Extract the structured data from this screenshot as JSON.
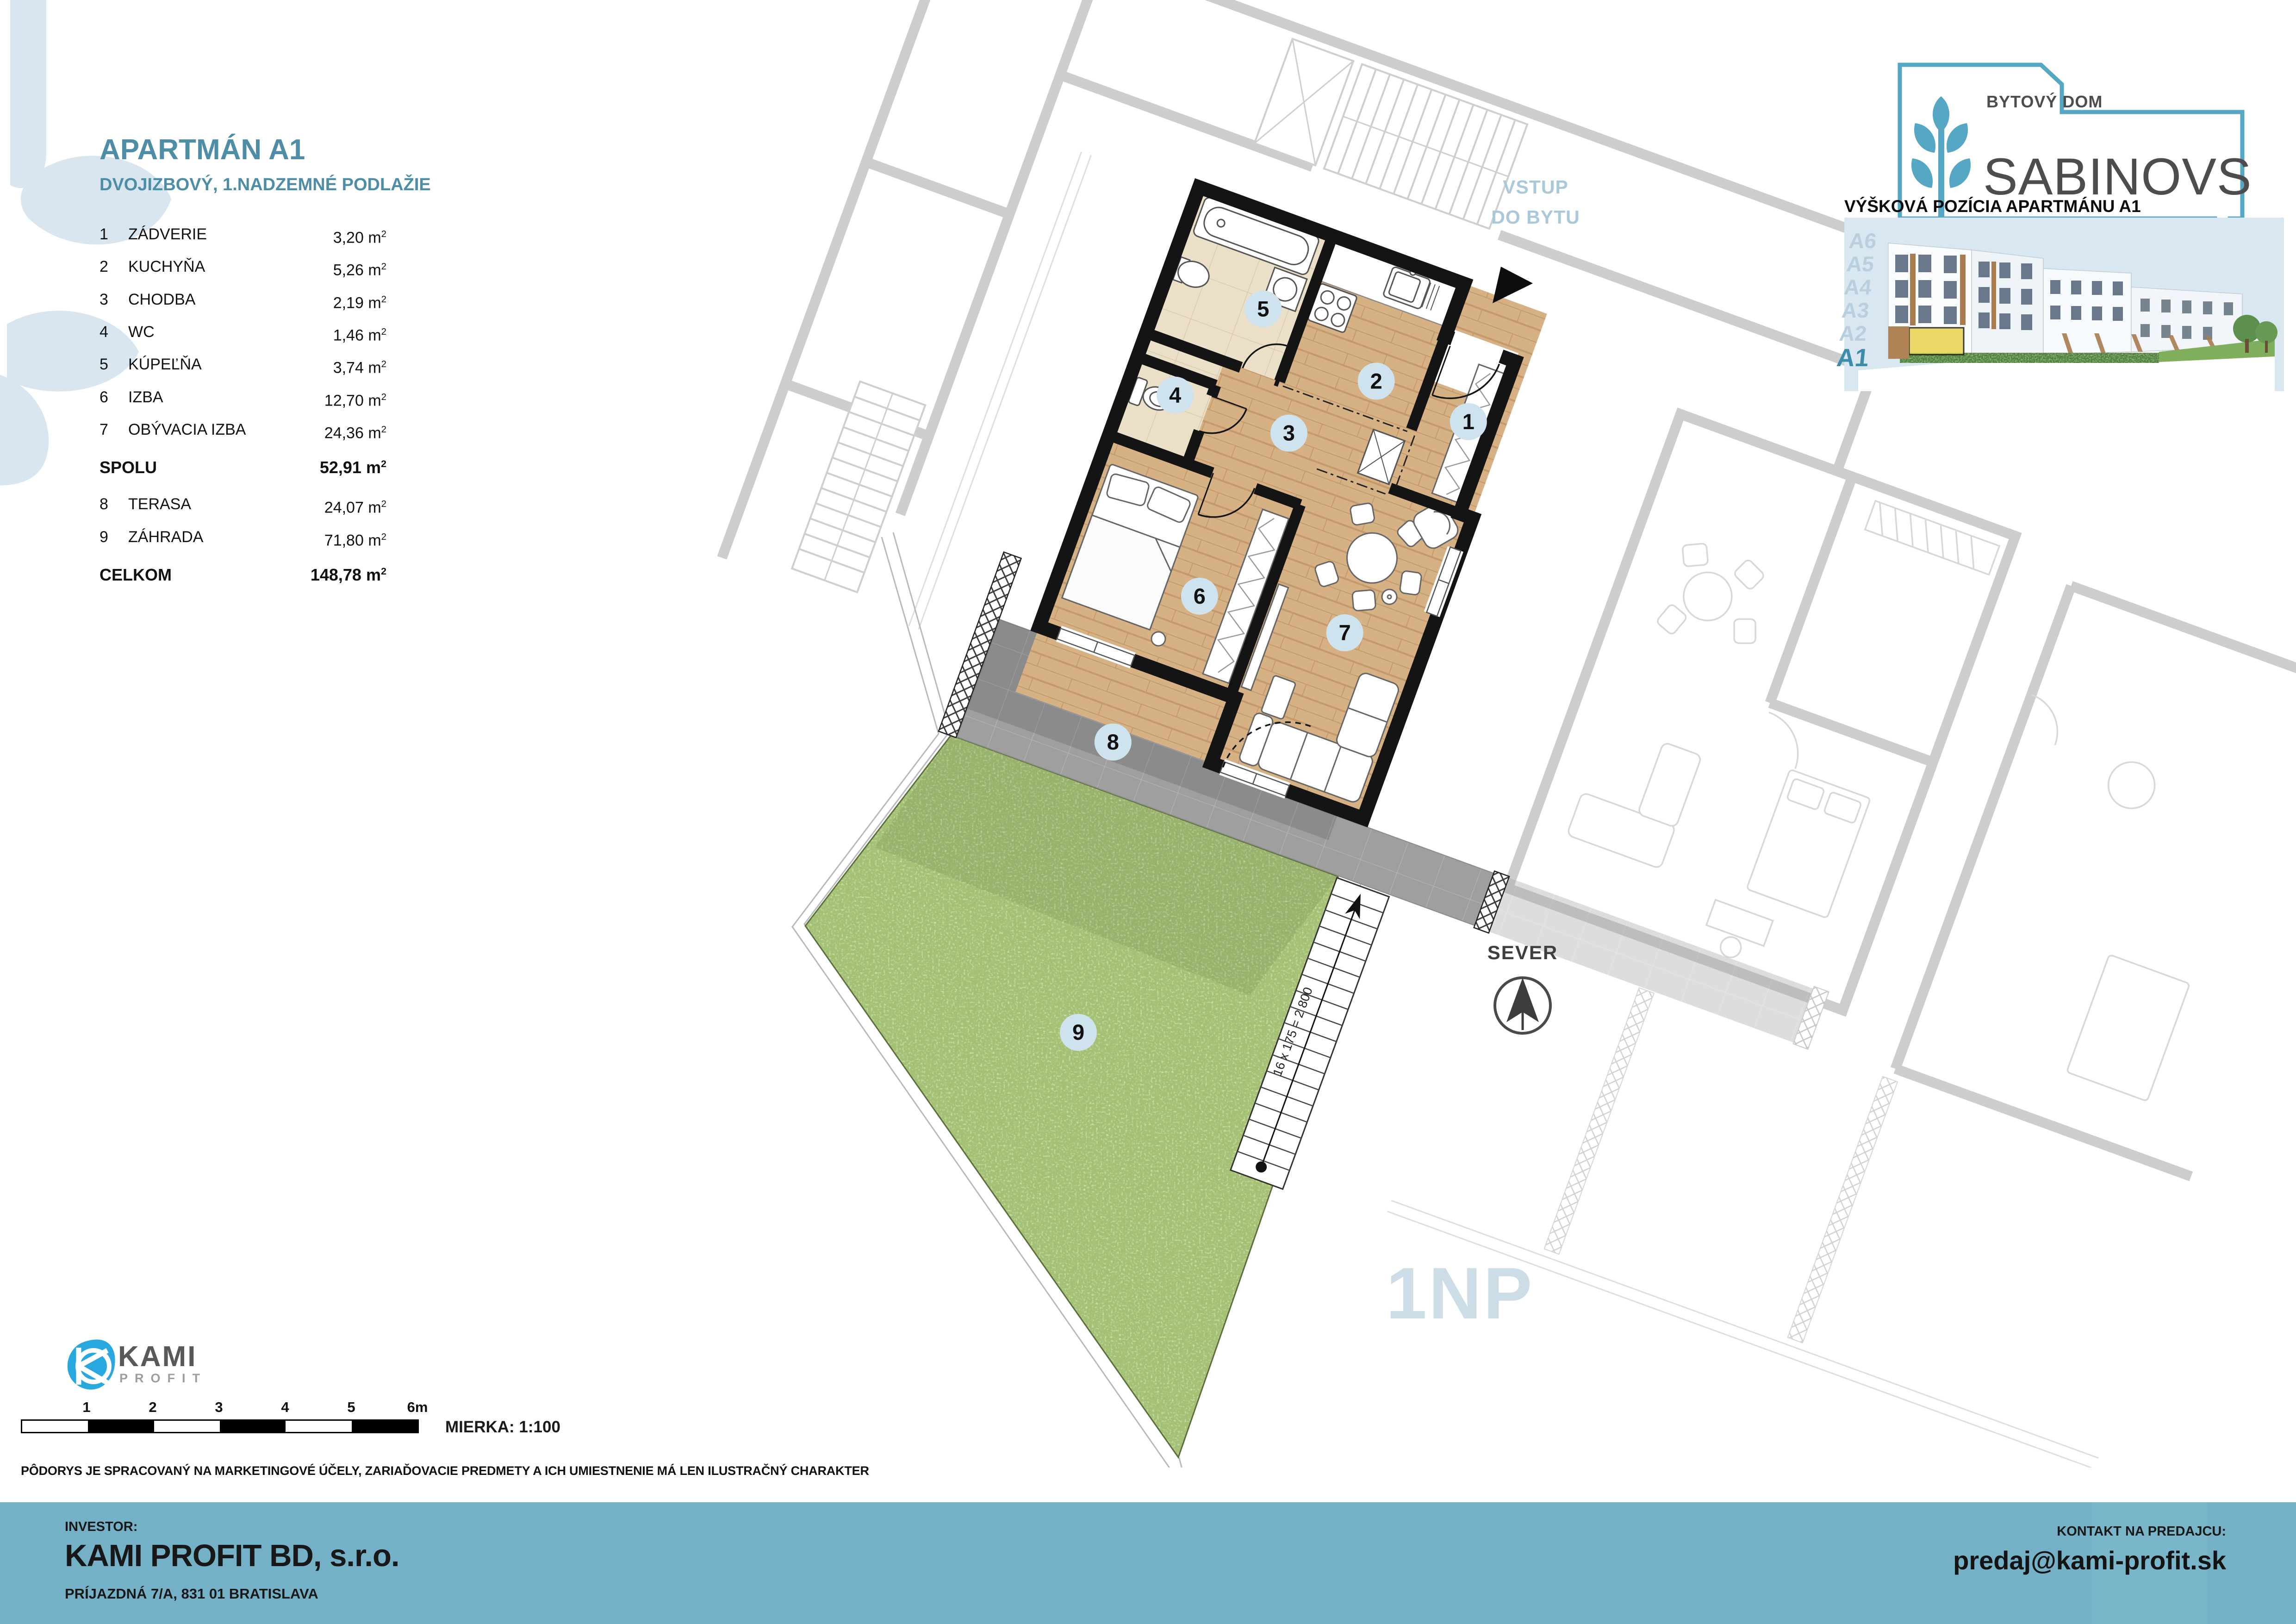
{
  "header": {
    "title": "APARTMÁN A1",
    "subtitle": "DVOJIZBOVÝ, 1.NADZEMNÉ PODLAŽIE"
  },
  "rooms": [
    {
      "no": "1",
      "name": "ZÁDVERIE",
      "value": "3,20"
    },
    {
      "no": "2",
      "name": "KUCHYŇA",
      "value": "5,26"
    },
    {
      "no": "3",
      "name": "CHODBA",
      "value": "2,19"
    },
    {
      "no": "4",
      "name": "WC",
      "value": "1,46"
    },
    {
      "no": "5",
      "name": "KÚPEĽŇA",
      "value": "3,74"
    },
    {
      "no": "6",
      "name": "IZBA",
      "value": "12,70"
    },
    {
      "no": "7",
      "name": "OBÝVACIA IZBA",
      "value": "24,36"
    }
  ],
  "outdoor": [
    {
      "no": "8",
      "name": "TERASA",
      "value": "24,07"
    },
    {
      "no": "9",
      "name": "ZÁHRADA",
      "value": "71,80"
    }
  ],
  "totals": {
    "spolu_label": "SPOLU",
    "spolu_value": "52,91",
    "celkom_label": "CELKOM",
    "celkom_value": "148,78"
  },
  "unit": {
    "base": "m",
    "sup": "2"
  },
  "plan": {
    "badges": [
      "1",
      "2",
      "3",
      "4",
      "5",
      "6",
      "7",
      "8",
      "9"
    ],
    "entry_line1": "VSTUP",
    "entry_line2": "DO BYTU",
    "north_label": "SEVER",
    "floor_label": "1NP",
    "stairs_label": "16 x 175 = 2 800"
  },
  "brand": {
    "top": "BYTOVÝ DOM",
    "name": "SABINOVSKÁ"
  },
  "elevation": {
    "title": "VÝŠKOVÁ POZÍCIA APARTMÁNU A1",
    "levels": [
      "A6",
      "A5",
      "A4",
      "A3",
      "A2",
      "A1"
    ]
  },
  "scalebar": {
    "ticks": [
      "1",
      "2",
      "3",
      "4",
      "5",
      "6m"
    ],
    "scale_label": "MIERKA: 1:100"
  },
  "disclaimer": "PÔDORYS JE SPRACOVANÝ NA MARKETINGOVÉ ÚČELY, ZARIAĎOVACIE PREDMETY A ICH UMIESTNENIE MÁ LEN ILUSTRAČNÝ CHARAKTER",
  "kami": {
    "name": "KAMI",
    "sub": "PROFIT"
  },
  "footer": {
    "investor_label": "INVESTOR:",
    "company": "KAMI PROFIT BD, s.r.o.",
    "address": "PRÍJAZDNÁ 7/A, 831 01 BRATISLAVA",
    "contact_label": "KONTAKT NA PREDAJCU:",
    "contact_email": "predaj@kami-profit.sk"
  },
  "colors": {
    "accent_teal": "#4d8da6",
    "footer_band": "#74b1c6",
    "badge_blue": "#cfe3ee",
    "logo_teal": "#55a7c3",
    "kami_blue": "#29a8e0",
    "highlight_yellow": "#e8d44d",
    "wood": "#d6b183",
    "grass": "#a3bf70",
    "terrace_grey": "#9f9f9f"
  }
}
